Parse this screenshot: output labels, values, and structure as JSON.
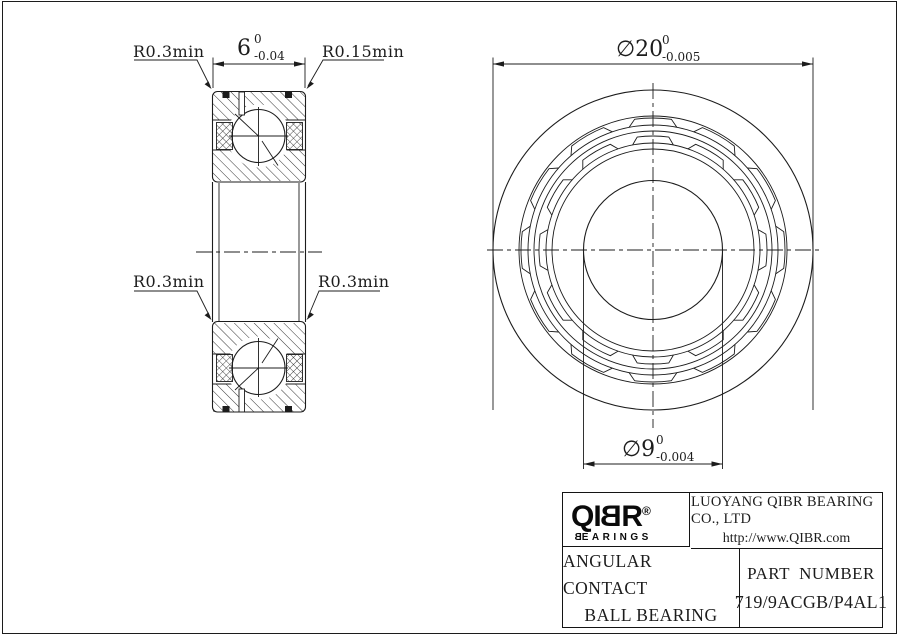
{
  "page": {
    "background": "#ffffff",
    "line_color": "#1c1c1c"
  },
  "dimensions": {
    "width": {
      "value": "6",
      "tol_upper": "0",
      "tol_lower": "-0.04"
    },
    "outer_diameter": {
      "value": "∅20",
      "tol_upper": "0",
      "tol_lower": "-0.005"
    },
    "bore_diameter": {
      "value": "∅9",
      "tol_upper": "0",
      "tol_lower": "-0.004"
    },
    "fillet_top_left": "R0.3min",
    "fillet_top_right": "R0.15min",
    "fillet_mid_left": "R0.3min",
    "fillet_mid_right": "R0.3min"
  },
  "front_view": {
    "cx": 653,
    "cy": 250,
    "radii": {
      "outer": 160,
      "ring2": 134,
      "cage_a_outer": 125,
      "cage_a_inner": 119,
      "cage_b_outer": 107,
      "cage_b_inner": 101,
      "bore": 69.5
    },
    "pocket_count": 12,
    "pocket_bulge": 7,
    "pocket_half_angle": 8,
    "pocket_tick_angle": 11,
    "cage_bands": [
      {
        "base_r": 125
      },
      {
        "base_r": 107
      }
    ]
  },
  "title_block": {
    "logo": {
      "prefix": "QI",
      "mirrored_letter": "B",
      "suffix": "R",
      "registered": "®",
      "sub_mirrored": "B",
      "sub_rest": "EARINGS"
    },
    "company": "LUOYANG QIBR BEARING CO., LTD",
    "website": "http://www.QIBR.com",
    "product_line1": "ANGULAR CONTACT",
    "product_line2": "BALL BEARING",
    "part_label": "PART  NUMBER",
    "part_number": "719/9ACGB/P4AL1"
  }
}
